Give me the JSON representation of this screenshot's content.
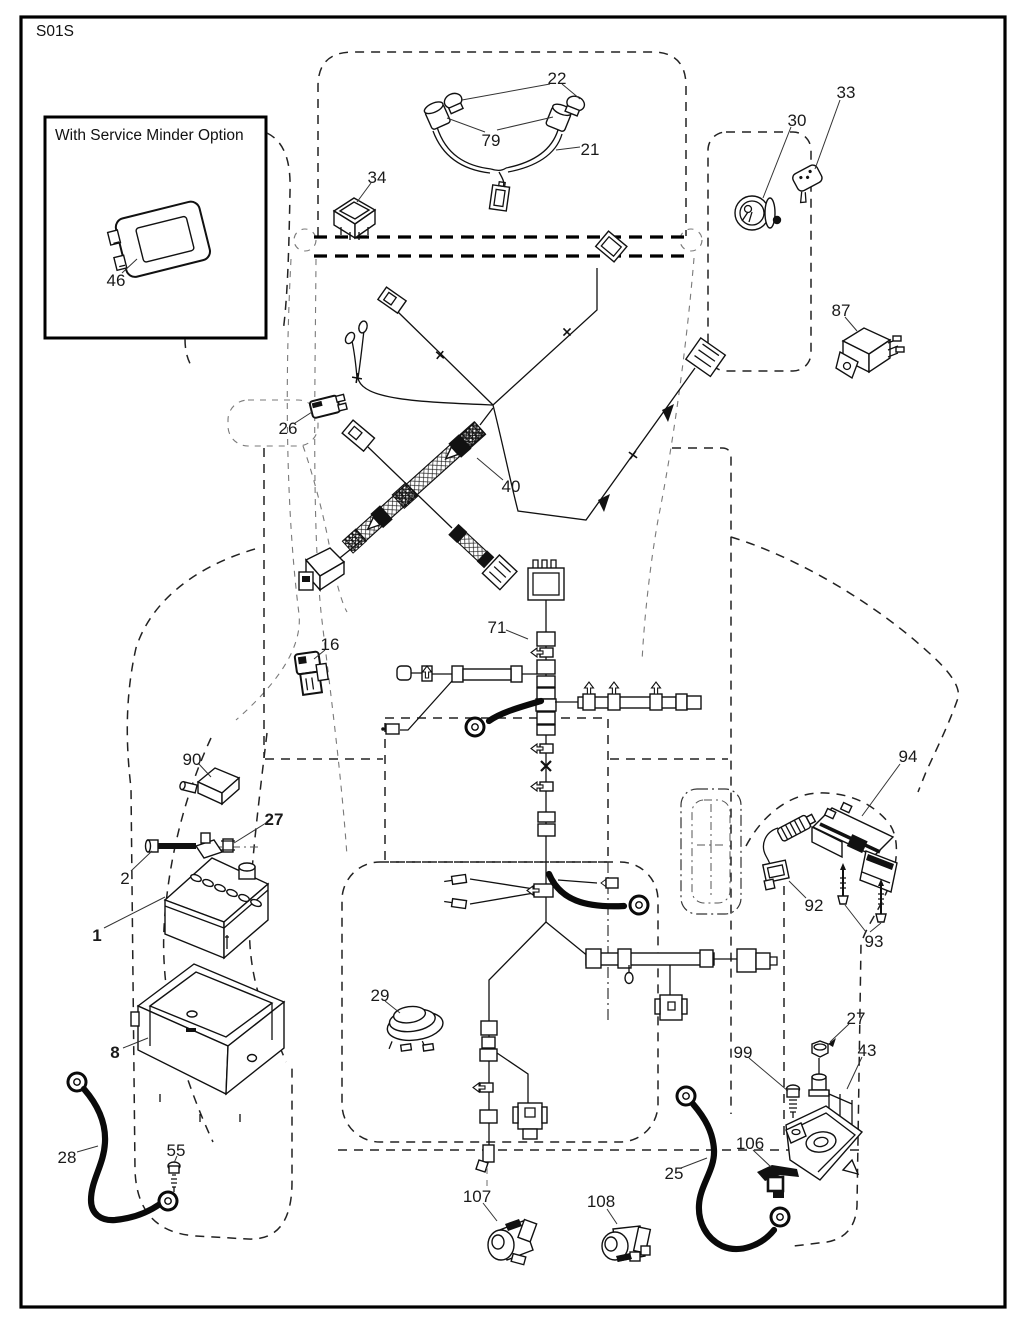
{
  "page": {
    "code": "S01S"
  },
  "inset": {
    "title": "With Service Minder Option"
  },
  "parts": [
    {
      "label": "22"
    },
    {
      "label": "79"
    },
    {
      "label": "21"
    },
    {
      "label": "34"
    },
    {
      "label": "30"
    },
    {
      "label": "33"
    },
    {
      "label": "87"
    },
    {
      "label": "26"
    },
    {
      "label": "40"
    },
    {
      "label": "71"
    },
    {
      "label": "16"
    },
    {
      "label": "90"
    },
    {
      "label": "27"
    },
    {
      "label": "2"
    },
    {
      "label": "1"
    },
    {
      "label": "8"
    },
    {
      "label": "28"
    },
    {
      "label": "55"
    },
    {
      "label": "29"
    },
    {
      "label": "107"
    },
    {
      "label": "108"
    },
    {
      "label": "25"
    },
    {
      "label": "99"
    },
    {
      "label": "27"
    },
    {
      "label": "43"
    },
    {
      "label": "106"
    },
    {
      "label": "92"
    },
    {
      "label": "94"
    },
    {
      "label": "93"
    },
    {
      "label": "46"
    }
  ]
}
